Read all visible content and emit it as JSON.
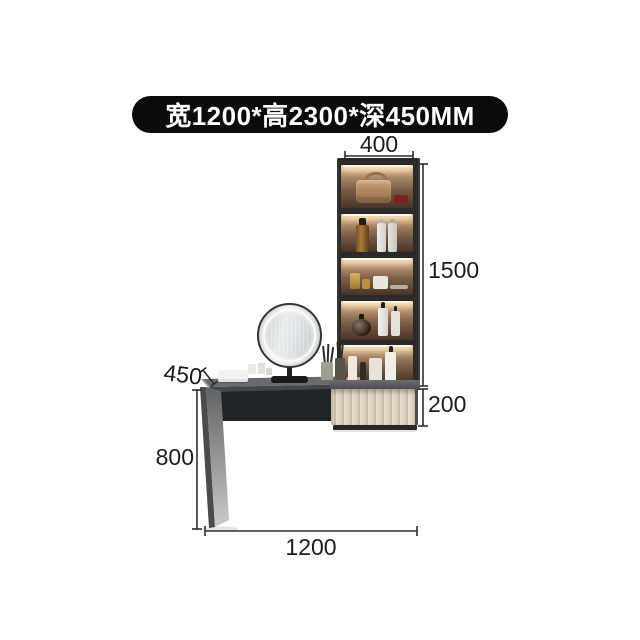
{
  "banner": {
    "text": "宽1200*高2300*深450MM",
    "bg_color": "#0c0c0c",
    "text_color": "#ffffff"
  },
  "dimensions": {
    "cabinet_width": {
      "label": "400"
    },
    "cabinet_height": {
      "label": "1500"
    },
    "drawer_height": {
      "label": "200"
    },
    "desk_depth": {
      "label": "450"
    },
    "desk_height": {
      "label": "800"
    },
    "total_width": {
      "label": "1200"
    }
  },
  "scene": {
    "type": "furniture-dimension-diagram",
    "items": [
      "wall-cabinet-with-lighted-shelves",
      "round-led-mirror",
      "dressing-desk",
      "wood-drawer-unit",
      "cosmetics-and-perfumes"
    ]
  },
  "style": {
    "dimension_line_color": "#2d2d2d",
    "label_color": "#1c1c1c",
    "wood_color": "#d9ceba",
    "cabinet_frame_color": "#2c2a28",
    "background": "#ffffff"
  }
}
